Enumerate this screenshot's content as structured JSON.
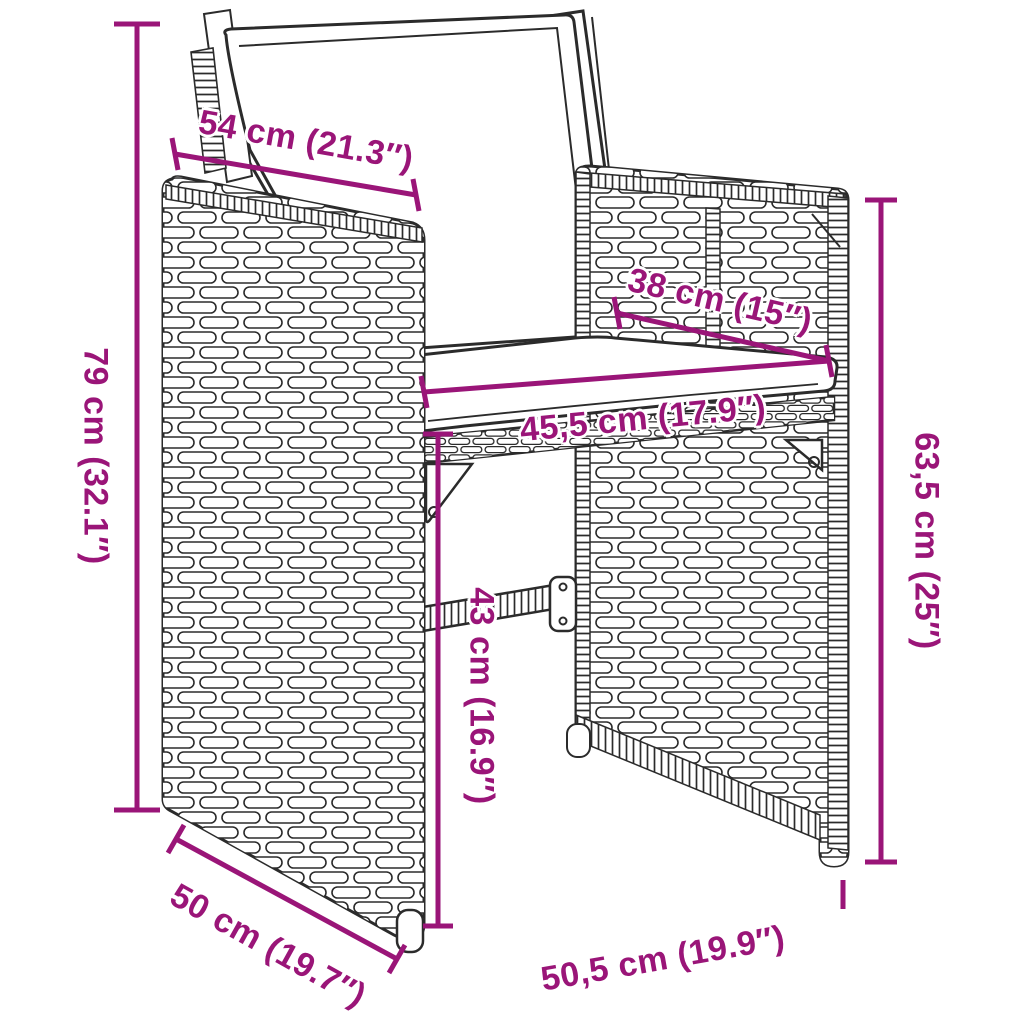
{
  "diagram": {
    "type": "furniture-dimension-diagram",
    "subject": "poly rattan garden chair with cushions",
    "accent_color": "#9A1578",
    "outline_color": "#2b2b2b",
    "background_color": "#ffffff",
    "dimensions": {
      "armrest_width": {
        "label": "54 cm (21.3″)"
      },
      "seat_depth": {
        "label": "38 cm (15″)"
      },
      "total_height": {
        "label": "79 cm (32.1″)"
      },
      "seat_width": {
        "label": "45,5 cm (17.9″)"
      },
      "seat_height": {
        "label": "43 cm (16.9″)"
      },
      "armrest_height": {
        "label": "63,5 cm (25″)"
      },
      "side_depth": {
        "label": "50 cm (19.7″)"
      },
      "front_width": {
        "label": "50,5 cm (19.9″)"
      }
    }
  }
}
